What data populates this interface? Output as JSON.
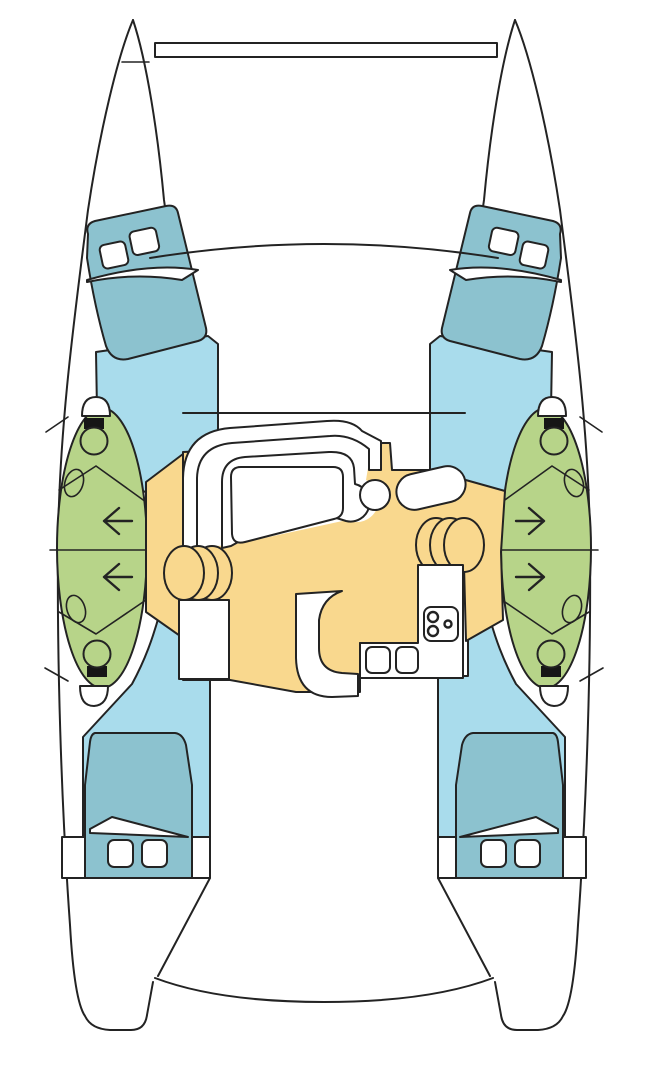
{
  "meta": {
    "type": "catamaran-floor-plan",
    "view": "top-down deck and accommodation plan",
    "description": "Top-view layout diagram of a sailing catamaran: two hulls with forward and aft double cabins, head compartments amidships in each hull, central salon with settee, table, galley with stove and twin sinks, companionway steps with direction arrows, bow crossbeam and trampoline area."
  },
  "colors": {
    "outline": "#232323",
    "hull": "#ffffff",
    "cabin_floor": "#a9dcec",
    "berth": "#8cc2cf",
    "head": "#b7d489",
    "salon_floor": "#f9d88e",
    "fixture_dark": "#161616"
  },
  "inventory": {
    "hulls": 2,
    "bow_crossbeam": 1,
    "forward_double_berths": 2,
    "forward_berth_pillows_each": 2,
    "aft_double_berths": 2,
    "aft_berth_hatches_each": 2,
    "head_compartments_per_hull": 2,
    "toilets_total": 4,
    "head_sinks_total": 4,
    "companionway_step_stacks": 2,
    "direction_arrows_port": "2 pointing outboard-left",
    "direction_arrows_starboard": "2 pointing outboard-right",
    "salon_settee": "curved wrap-around bench with table",
    "nav_seat": 1,
    "galley_stove_burners": 3,
    "galley_sinks": 2
  }
}
